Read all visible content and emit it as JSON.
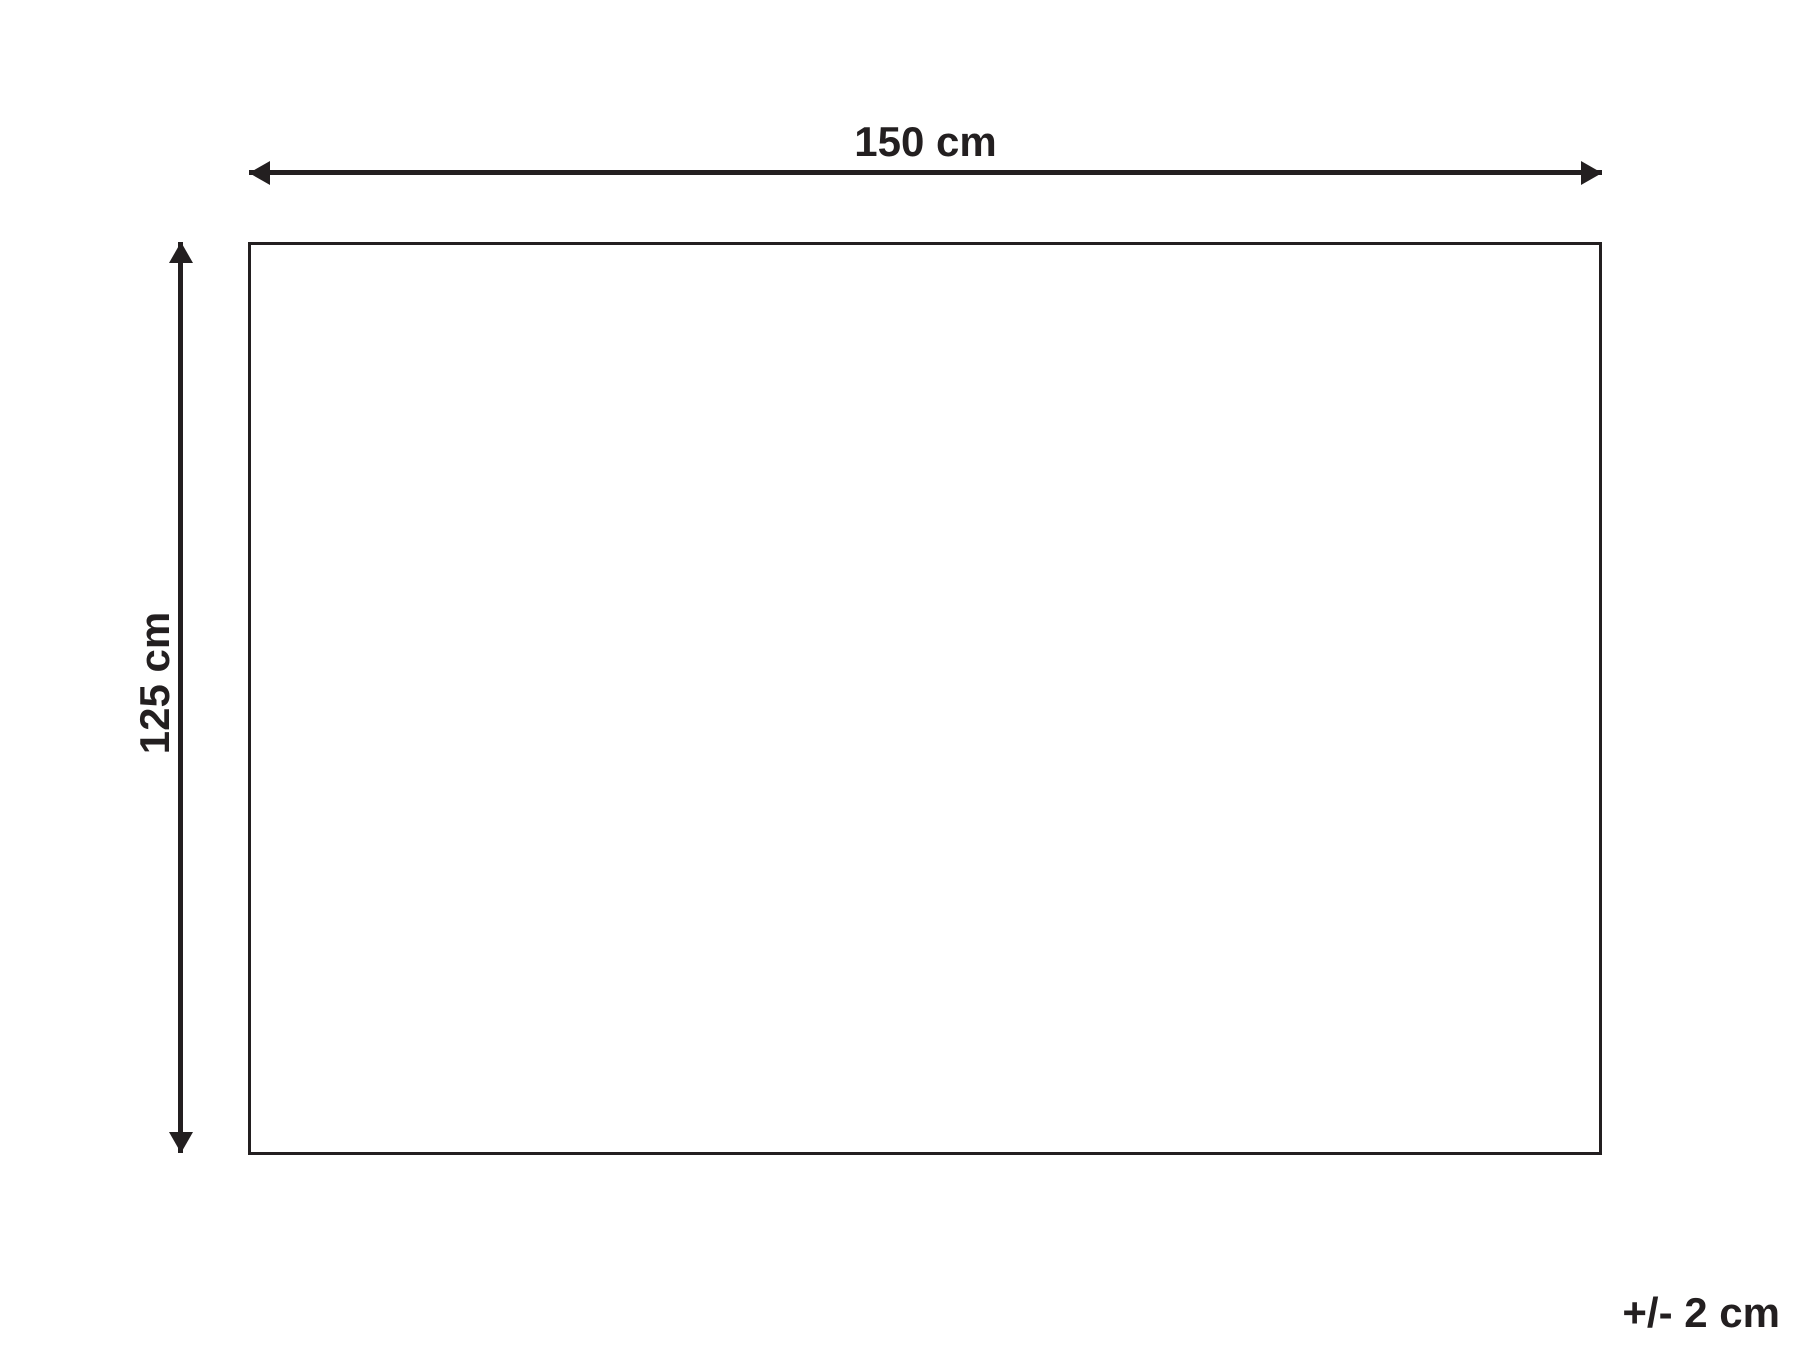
{
  "diagram": {
    "type": "product-dimension-diagram",
    "width_label": "150 cm",
    "height_label": "125 cm",
    "tolerance_label": "+/- 2 cm",
    "ink_color": "#231f20",
    "background_color": "#ffffff"
  }
}
